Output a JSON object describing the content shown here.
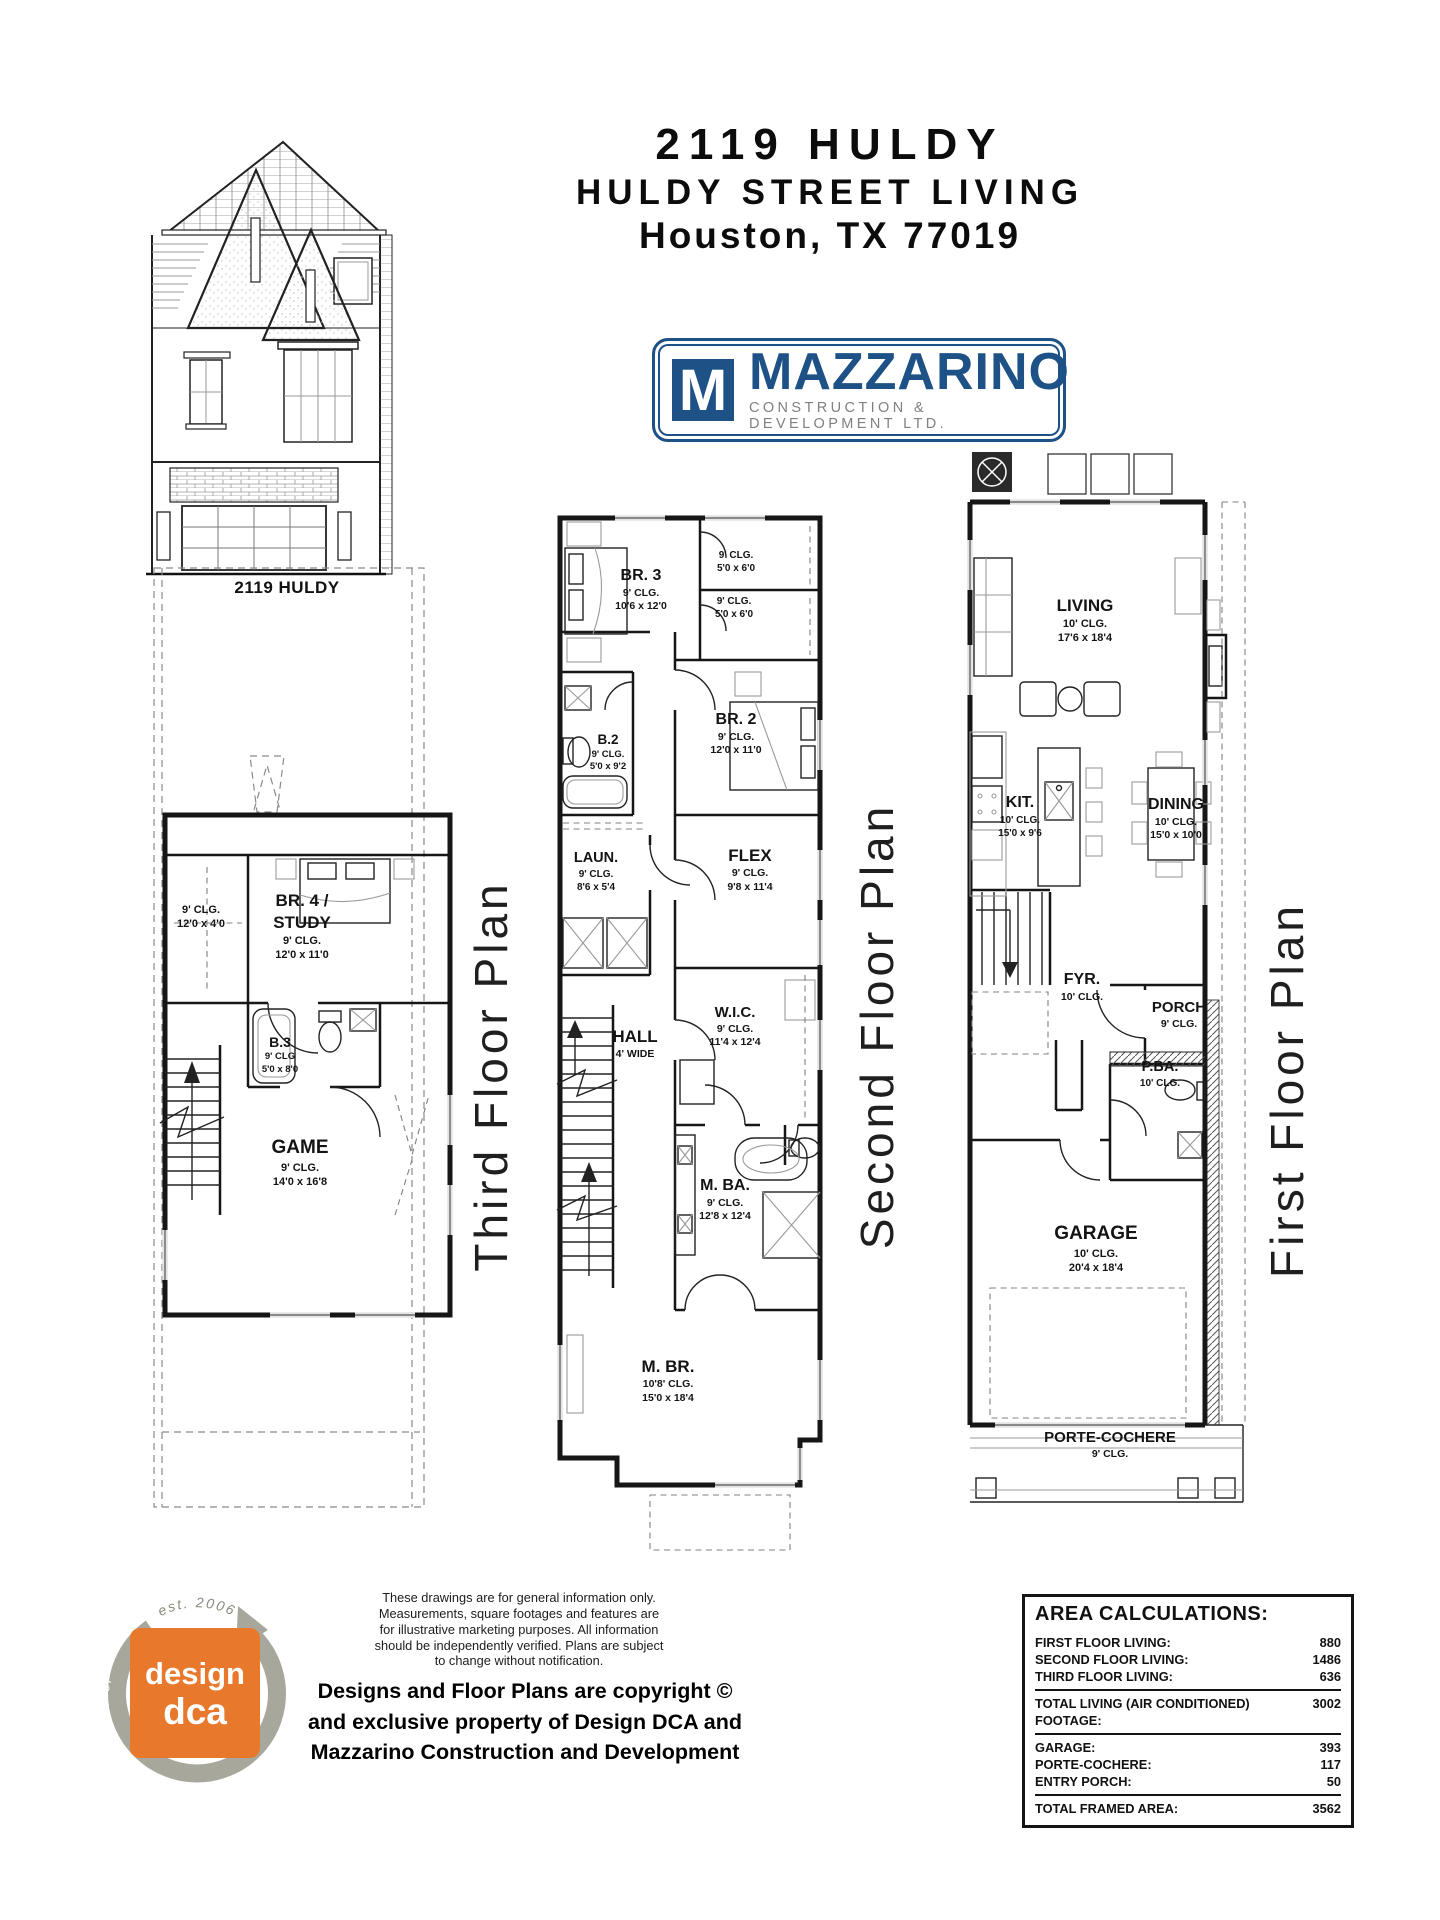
{
  "header": {
    "address": "2119 HULDY",
    "subtitle": "HULDY STREET LIVING",
    "city": "Houston, TX 77019"
  },
  "brand": {
    "monogram": "M",
    "name": "MAZZARINO",
    "tagline": "CONSTRUCTION & DEVELOPMENT LTD.",
    "blue": "#1e5185",
    "gray": "#7f8084"
  },
  "elevation": {
    "caption": "2119 HULDY"
  },
  "plans": {
    "third": {
      "title": "Third Floor Plan",
      "rooms": {
        "attic": {
          "clg": "9' CLG.",
          "dims": "12'0 x 4'0"
        },
        "br4": {
          "name1": "BR. 4 /",
          "name2": "STUDY",
          "clg": "9' CLG.",
          "dims": "12'0 x 11'0"
        },
        "b3": {
          "name": "B.3",
          "clg": "9' CLG",
          "dims": "5'0 x 8'0"
        },
        "game": {
          "name": "GAME",
          "clg": "9' CLG.",
          "dims": "14'0 x 16'8"
        }
      }
    },
    "second": {
      "title": "Second Floor Plan",
      "rooms": {
        "br3": {
          "name": "BR. 3",
          "clg": "9' CLG.",
          "dims": "10'6 x 12'0"
        },
        "closet_a": {
          "clg": "9' CLG.",
          "dims": "5'0 x 6'0"
        },
        "closet_b": {
          "clg": "9' CLG.",
          "dims": "5'0 x 6'0"
        },
        "b2": {
          "name": "B.2",
          "clg": "9' CLG.",
          "dims": "5'0 x 9'2"
        },
        "br2": {
          "name": "BR. 2",
          "clg": "9' CLG.",
          "dims": "12'0 x 11'0"
        },
        "laun": {
          "name": "LAUN.",
          "clg": "9' CLG.",
          "dims": "8'6 x 5'4"
        },
        "flex": {
          "name": "FLEX",
          "clg": "9' CLG.",
          "dims": "9'8 x 11'4"
        },
        "hall": {
          "name": "HALL",
          "dims": "4' WIDE"
        },
        "wic": {
          "name": "W.I.C.",
          "clg": "9' CLG.",
          "dims": "11'4 x 12'4"
        },
        "mba": {
          "name": "M. BA.",
          "clg": "9' CLG.",
          "dims": "12'8 x 12'4"
        },
        "mbr": {
          "name": "M. BR.",
          "clg": "10'8' CLG.",
          "dims": "15'0 x 18'4"
        }
      }
    },
    "first": {
      "title": "First Floor Plan",
      "rooms": {
        "living": {
          "name": "LIVING",
          "clg": "10' CLG.",
          "dims": "17'6 x 18'4"
        },
        "kit": {
          "name": "KIT.",
          "clg": "10' CLG.",
          "dims": "15'0 x 9'6"
        },
        "dining": {
          "name": "DINING",
          "clg": "10' CLG.",
          "dims": "15'0 x 10'0"
        },
        "fyr": {
          "name": "FYR.",
          "clg": "10' CLG."
        },
        "porch": {
          "name": "PORCH",
          "clg": "9' CLG."
        },
        "pba": {
          "name": "P.BA.",
          "clg": "10' CLG."
        },
        "garage": {
          "name": "GARAGE",
          "clg": "10' CLG.",
          "dims": "20'4 x 18'4"
        },
        "porte": {
          "name": "PORTE-COCHERE",
          "clg": "9' CLG."
        }
      }
    }
  },
  "footer": {
    "dca": {
      "word1": "design",
      "word2": "dca",
      "est": "est. 2006",
      "motto": "design matters",
      "orange": "#e8792c"
    },
    "disclaimer": [
      "These drawings are for general information only.",
      "Measurements, square footages and features are",
      "for illustrative marketing purposes. All information",
      "should be independently verified. Plans are subject",
      "to change without notification."
    ],
    "copyright": [
      "Designs and Floor Plans are copyright ©",
      "and exclusive property of  Design DCA and",
      "Mazzarino Construction and Development"
    ],
    "area": {
      "title": "AREA CALCULATIONS:",
      "rows": [
        {
          "label": "FIRST FLOOR LIVING:",
          "value": "880"
        },
        {
          "label": "SECOND FLOOR LIVING:",
          "value": "1486"
        },
        {
          "label": "THIRD FLOOR LIVING:",
          "value": "636"
        },
        {
          "label": "TOTAL LIVING (AIR CONDITIONED) FOOTAGE:",
          "value": "3002"
        },
        {
          "label": "GARAGE:",
          "value": "393"
        },
        {
          "label": "PORTE-COCHERE:",
          "value": "117"
        },
        {
          "label": "ENTRY PORCH:",
          "value": "50"
        },
        {
          "label": "TOTAL FRAMED AREA:",
          "value": "3562"
        }
      ]
    }
  }
}
